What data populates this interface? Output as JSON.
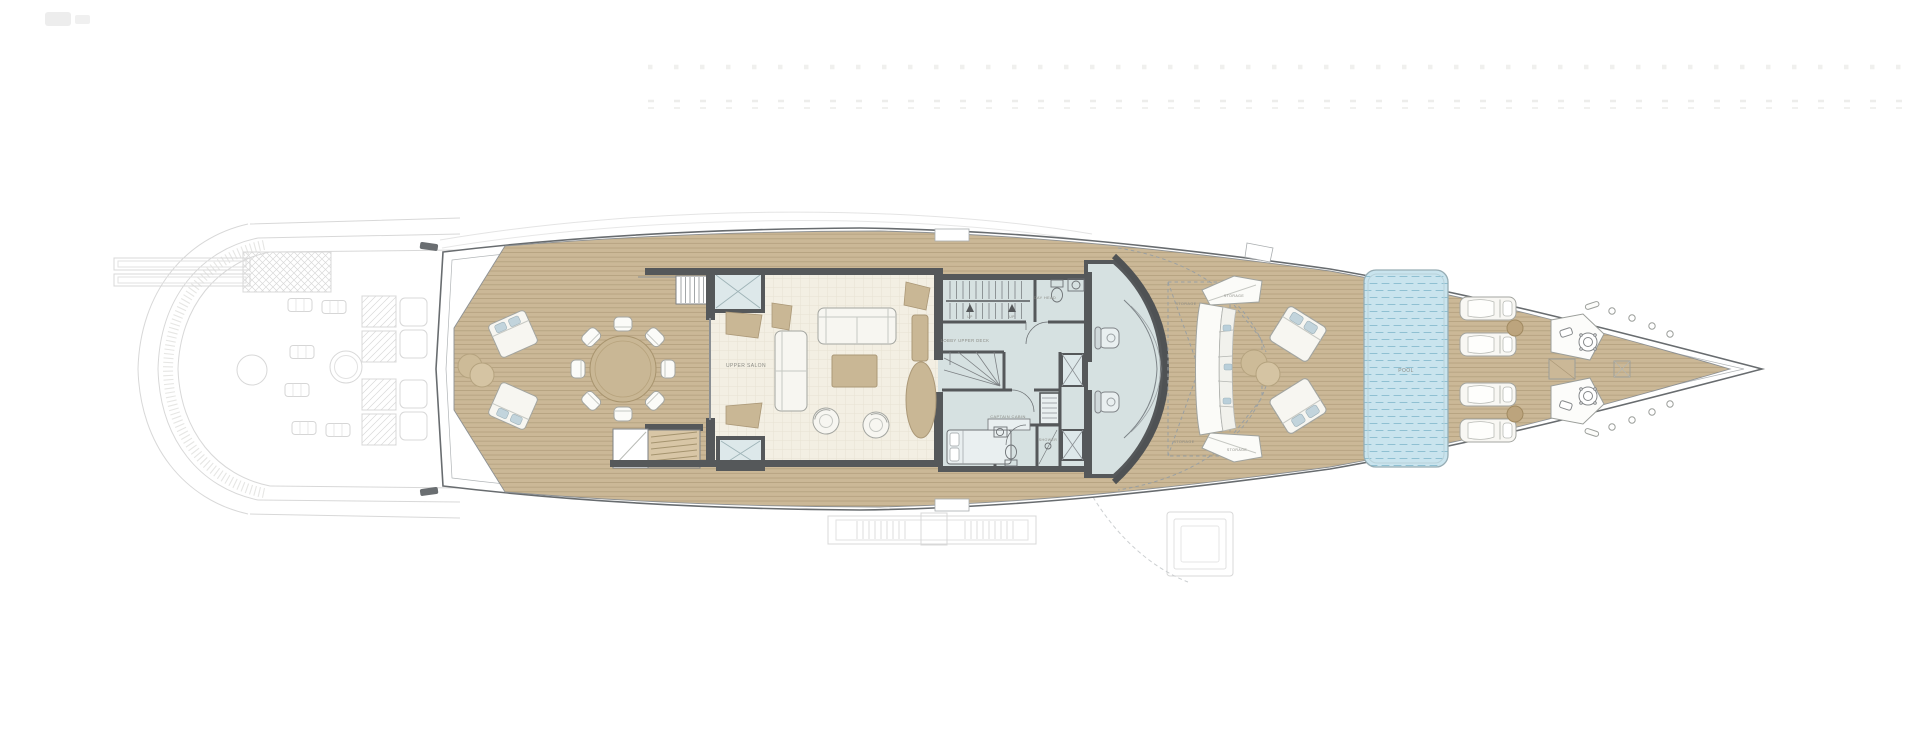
{
  "colors": {
    "deck_teak": "#cbb897",
    "deck_plank_line": "#b3a07e",
    "salon_floor": "#f3efe3",
    "cabin_floor_blue": "#d6e1e1",
    "wall_grey": "#55585a",
    "pool_water": "#c9e4ee",
    "pool_wave": "#8fc0d2",
    "wood_furniture": "#c9b795",
    "hull_outline": "#686c6f",
    "ghost_line": "#d8d8d8"
  },
  "labels": {
    "upper_salon": "UPPER SALON",
    "lobby_upper_deck": "LOBBY UPPER DECK",
    "day_head": "DAY HEAD",
    "captain_cabin": "CAPTAIN CABIN",
    "shower": "SHOWER",
    "storage": "STORAGE",
    "pool": "POOL",
    "up": "UP"
  }
}
